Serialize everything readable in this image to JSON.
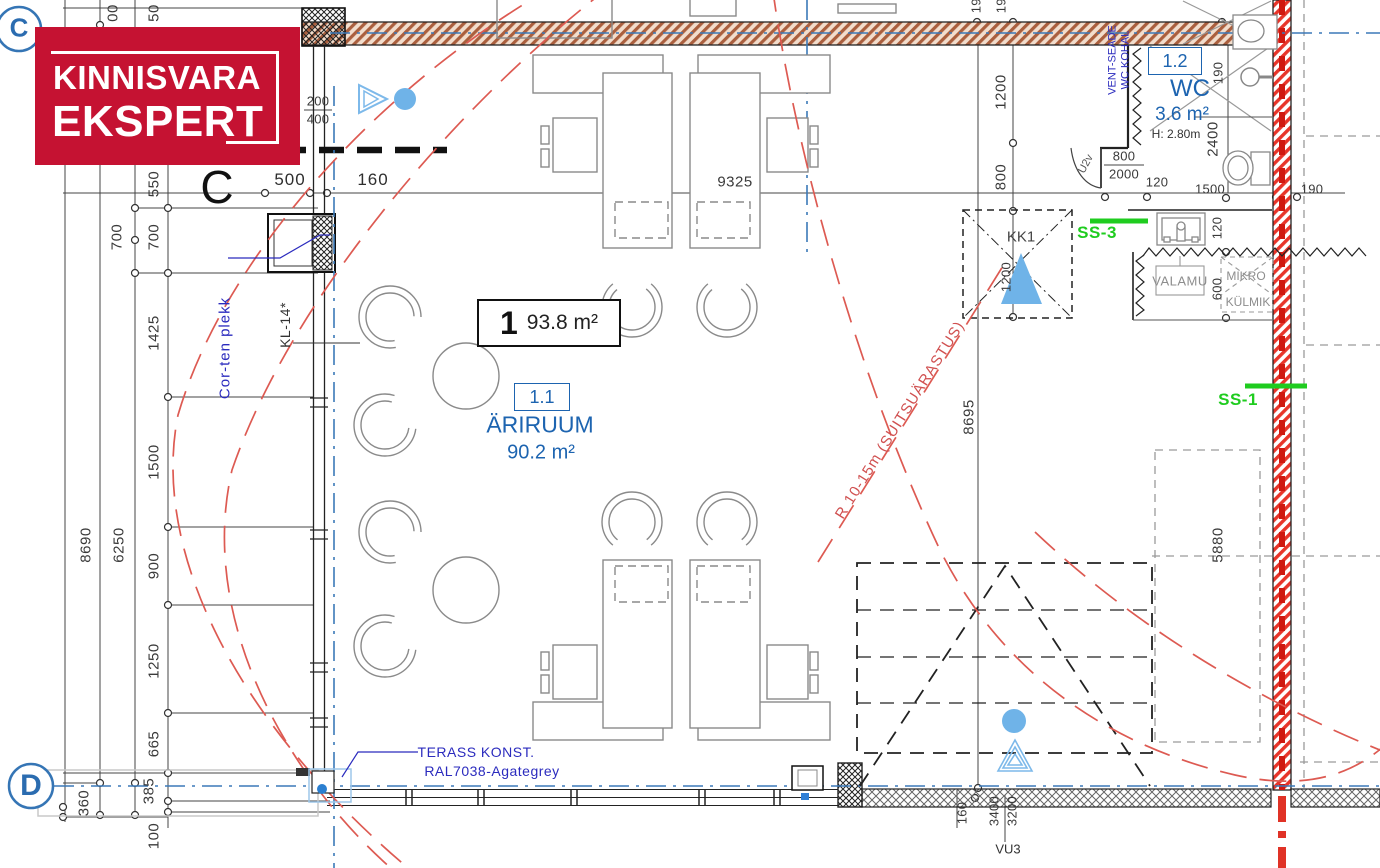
{
  "colors": {
    "logo_red": "#c51232",
    "room_blue": "#1d64b0",
    "annotation_blue": "#2b2bbe",
    "marker_green": "#1fcc1f",
    "arc_red": "#dd5a52",
    "firewall_red": "#e8352a",
    "wall_hatch_brown": "#aa5f3e",
    "icon_light_blue": "#6fb3e8"
  },
  "logo": {
    "line1": "KINNISVARA",
    "line2": "EKSPERT"
  },
  "grid": {
    "c": "C",
    "d": "D",
    "c_label": "C"
  },
  "unit": {
    "number": "1",
    "area": "93.8 m²"
  },
  "room_main": {
    "code": "1.1",
    "name": "ÄRIRUUM",
    "area": "90.2 m²"
  },
  "room_wc": {
    "code": "1.2",
    "name": "WC",
    "area": "3.6 m²",
    "height": "H: 2.80m"
  },
  "labels": {
    "kk1": "KK1",
    "ss3": "SS-3",
    "ss1": "SS-1",
    "u2v": "U2v",
    "vu3": "VU3",
    "valamu": "VALAMU",
    "mikro": "MIKRO",
    "kylmik": "KÜLMIK",
    "smoke_radius": "R 10-15m (SUITSUÄRASTUS)",
    "corten": "Cor-ten plekk",
    "kl14": "KL-14*",
    "vent1": "VENT-SEADE",
    "vent2": "WC KOHAL",
    "terass1": "TERASS KONST.",
    "terass2": "RAL7038-Agategrey"
  },
  "dims": {
    "left": [
      "00",
      "50",
      "700",
      "550",
      "700",
      "1425",
      "1500",
      "900",
      "1250",
      "665",
      "385",
      "100",
      "360",
      "8690",
      "6250"
    ],
    "top": [
      "200",
      "400",
      "500",
      "160",
      "9325",
      "800",
      "2000",
      "120",
      "1500",
      "190"
    ],
    "right": [
      "190",
      "190",
      "1200",
      "800",
      "190",
      "2400",
      "120",
      "600",
      "1200",
      "8695",
      "5880"
    ],
    "bottom": [
      "160",
      "3400",
      "3200"
    ]
  }
}
